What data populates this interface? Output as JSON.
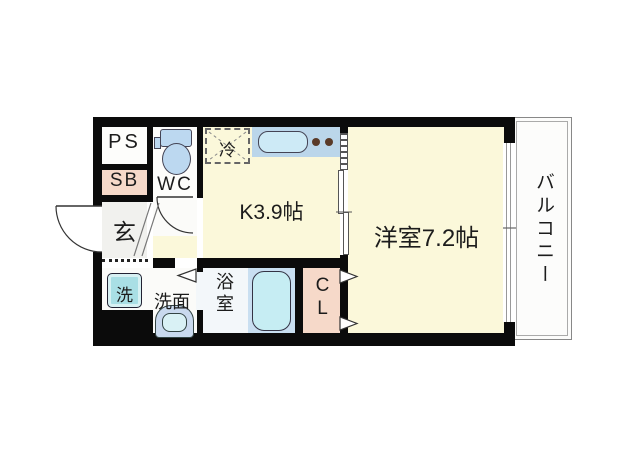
{
  "floorplan": {
    "labels": {
      "ps": "PS",
      "shoe_box": "SB",
      "toilet": "WC",
      "entrance": "玄",
      "refrigerator": "冷",
      "kitchen": "K3.9帖",
      "western_room": "洋室7.2帖",
      "balcony": "バルコニー",
      "washer": "洗",
      "vanity": "洗面",
      "bathroom": "浴室",
      "closet": "CL"
    },
    "colors": {
      "wall": "#0b0b0b",
      "floor_yellow": "#fbf8da",
      "accent_pink": "#f6d9c9",
      "counter_blue": "#bbd6ea",
      "fixture_blue": "#bcd8f0",
      "sink_fill": "#cdeaf6",
      "tub_fill": "#c6edf3",
      "panel_blue": "#c9dff1",
      "washer_cyan": "#a9dfe5",
      "basin_fill": "#d9f1f5",
      "basin_body": "#c9d9ee",
      "bath_floor": "#f3f7fa",
      "genkan_gray": "#f1f1ee",
      "burner_brown": "#5a3a28"
    }
  }
}
